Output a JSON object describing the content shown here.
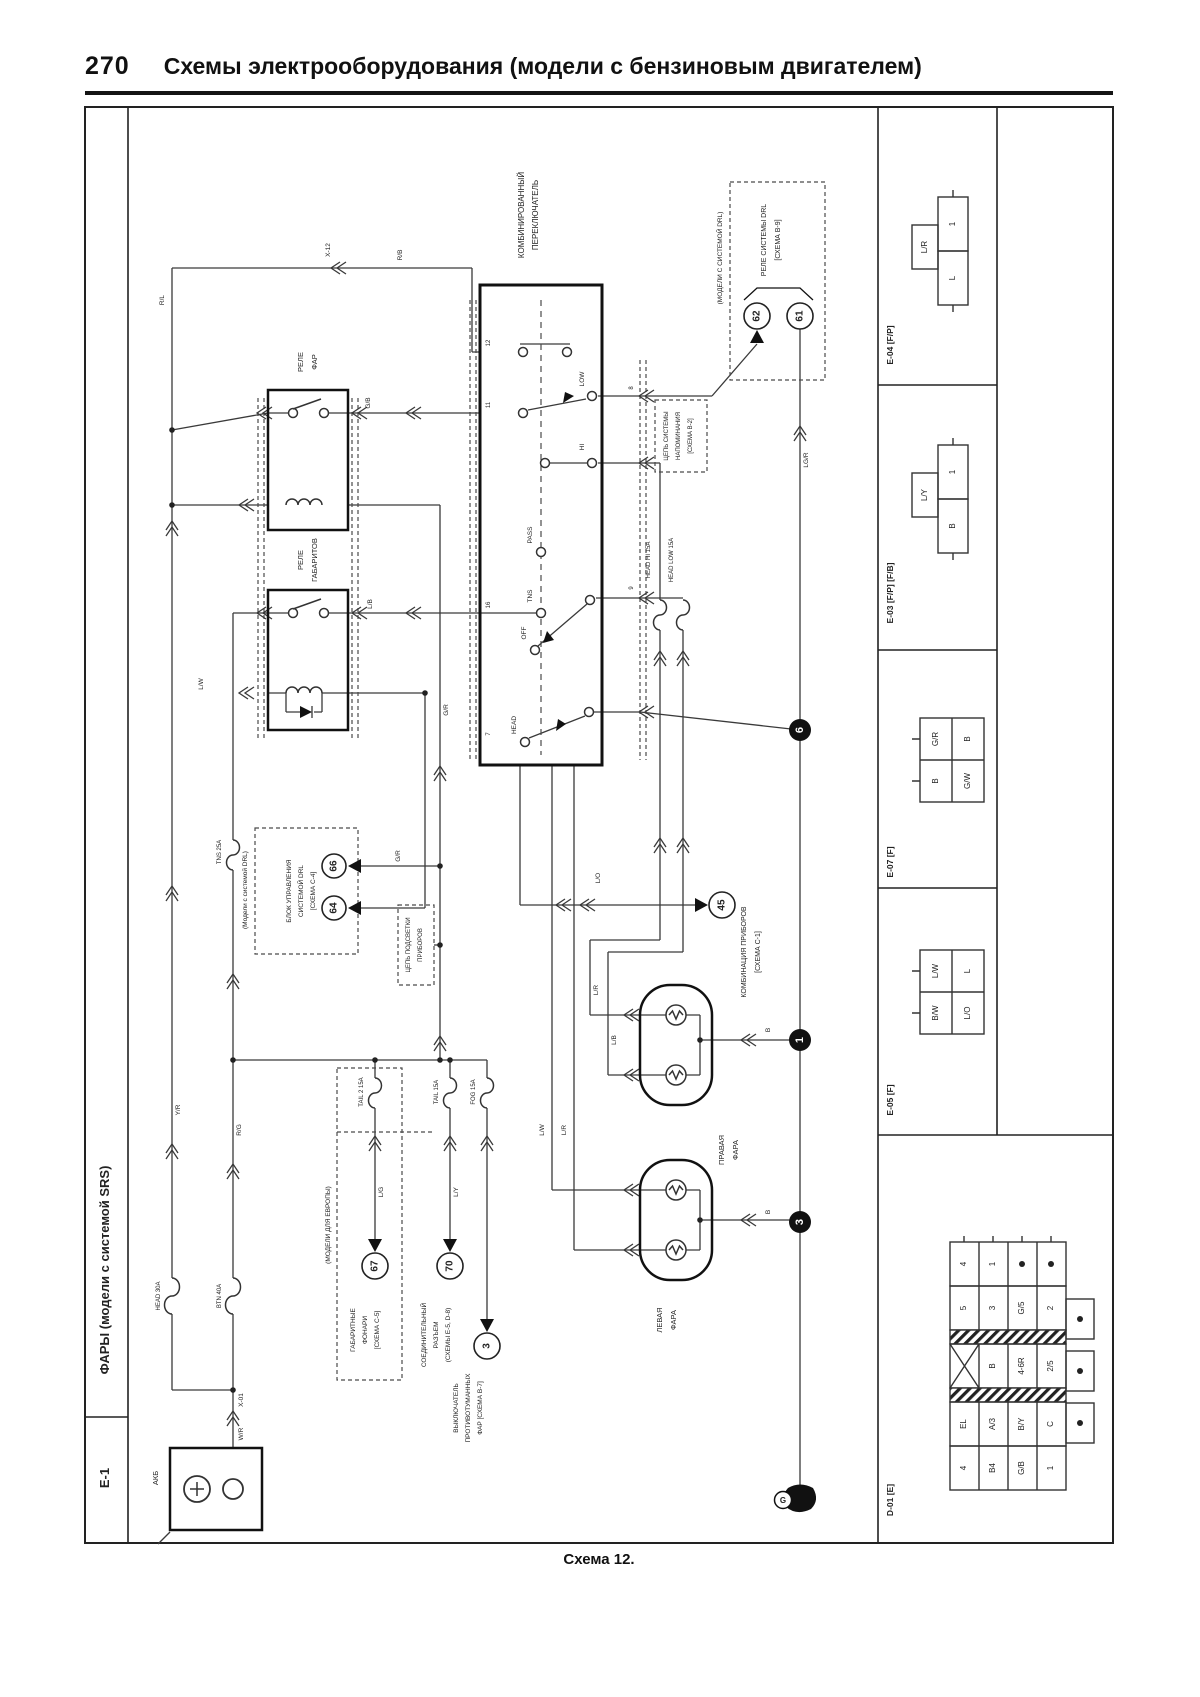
{
  "page": {
    "number": "270",
    "title": "Схемы электрооборудования (модели с бензиновым двигателем)",
    "caption": "Схема 12."
  },
  "sidebar": {
    "system": "ФАРЫ (модели с системой SRS)",
    "code": "E-1"
  },
  "comp": {
    "cs1": "КОМБИНИРОВАННЫЙ",
    "cs2": "ПЕРЕКЛЮЧАТЕЛЬ",
    "hr1": "РЕЛЕ",
    "hr2": "ФАР",
    "tr1": "РЕЛЕ",
    "tr2": "ГАБАРИТОВ",
    "drlm1": "(МОДЕЛИ С СИСТЕМОЙ DRL)",
    "drlr1": "РЕЛЕ СИСТЕМЫ DRL",
    "drlr2": "[СХЕМА В-9]",
    "drlm2": "(Модели с системой DRL)",
    "du1": "БЛОК УПРАВЛЕНИЯ",
    "du2": "СИСТЕМОЙ DRL",
    "du3": "[СХЕМА С-4]",
    "mt1": "КОМБИНАЦИЯ ПРИБОРОВ",
    "mt2": "[СХЕМА С-1]",
    "rl1": "ПРАВАЯ",
    "rl2": "ФАРА",
    "ll1": "ЛЕВАЯ",
    "ll2": "ФАРА",
    "eur": "(МОДЕЛИ ДЛЯ ЕВРОПЫ)",
    "tl1": "ГАБАРИТНЫЕ",
    "tl2": "ФОНАРИ",
    "tl3": "[СХЕМА С-5]",
    "jn1": "СОЕДИНИТЕЛЬНЫЙ",
    "jn2": "РАЗЪЕМ",
    "jn3": "(СХЕМЫ Е-5, D-8)",
    "fg1": "ВЫКЛЮЧАТЕЛЬ",
    "fg2": "ПРОТИВОТУМАННЫХ",
    "fg3": "ФАР [СХЕМА В-7]",
    "rm1": "ЦЕПЬ СИСТЕМЫ",
    "rm2": "НАПОМИНАНИЯ",
    "rm3": "[СХЕМА В-2]",
    "il1": "ЦЕПЬ ПОДСВЕТКИ",
    "il2": "ПРИБОРОВ",
    "bat": "АКБ"
  },
  "fuse": {
    "hl": "HEAD 30A",
    "bl": "BTN 40A",
    "tns": "TNS 25A",
    "hh": "HEAD HI 15A",
    "hlow": "HEAD LOW 15A",
    "t2": "TAIL 2 15A",
    "t1": "TAIL 15A",
    "fog": "FOG 15A"
  },
  "sw": {
    "low": "LOW",
    "hi": "HI",
    "pass": "PASS",
    "off": "OFF",
    "tns": "TNS",
    "head": "HEAD",
    "p12": "12",
    "p11": "11",
    "p16": "16",
    "p8": "8",
    "p9": "9",
    "p7": "7"
  },
  "ref": {
    "c62": "62",
    "c61": "61",
    "c45": "45",
    "c66": "66",
    "c64": "64",
    "c67": "67",
    "c70": "70",
    "c3": "3",
    "b6": "6",
    "b1": "1",
    "b3": "3",
    "g": "G"
  },
  "wire": {
    "rb": "R/B",
    "rl": "R/L",
    "yr": "Y/R",
    "rg": "R/G",
    "wr": "W/R",
    "gb": "G/B",
    "gr": "G/R",
    "lb": "L/B",
    "lw": "L/W",
    "lr": "L/R",
    "lo": "L/O",
    "ly": "L/Y",
    "lg": "L/G",
    "lgr": "LG/R",
    "b": "B",
    "x12": "X-12",
    "x01": "X-01"
  },
  "conn": {
    "e04": {
      "label": "E-04 [F/P]",
      "tab": "L/R",
      "c1": "1",
      "c2": "L"
    },
    "e03": {
      "label": "E-03 [F/P] [F/B]",
      "tab": "L/Y",
      "c1": "1",
      "c2": "B"
    },
    "e07": {
      "label": "E-07 [F]",
      "c": [
        "G/R",
        "B",
        "B",
        "G/W"
      ]
    },
    "e05": {
      "label": "E-05 [F]",
      "c": [
        "L/W",
        "L",
        "B/W",
        "L/O"
      ]
    },
    "d01": {
      "label": "D-01 [E]",
      "r1": [
        "4",
        "1"
      ],
      "r2": [
        "5",
        "3",
        "G/5",
        "2"
      ],
      "r3": [
        "B",
        "4-6R",
        "2/5"
      ],
      "r4": [
        "EL",
        "A/3",
        "B/Y",
        "C"
      ],
      "r5": [
        "4",
        "B4",
        "G/B",
        "1"
      ]
    }
  },
  "colors": {
    "ink": "#222222",
    "paper": "#ffffff"
  }
}
